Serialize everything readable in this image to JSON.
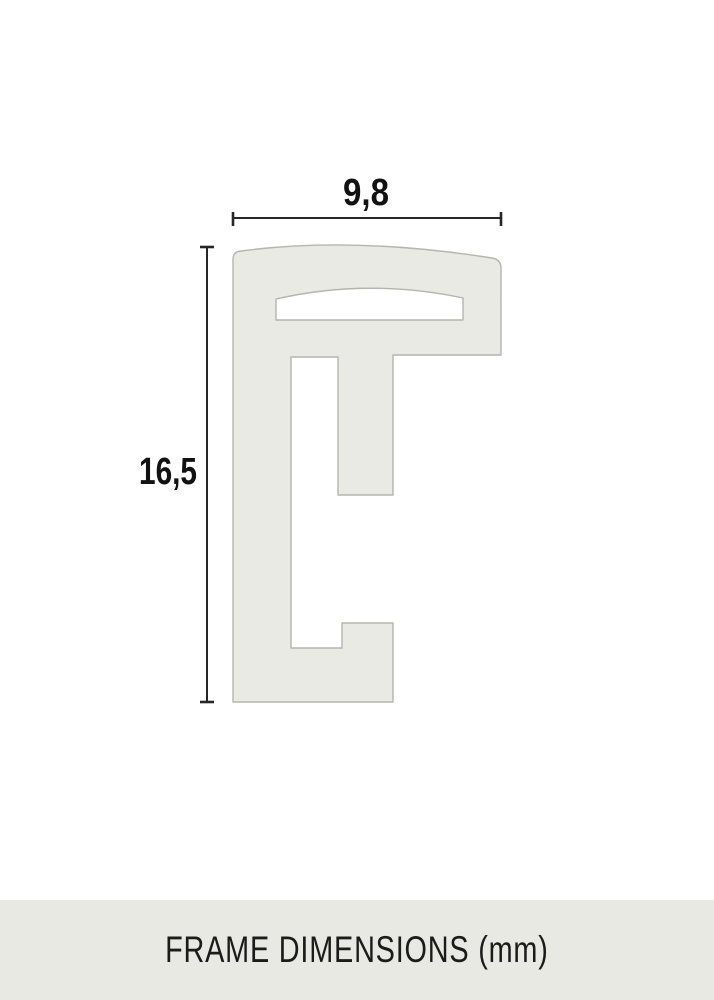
{
  "dimensions": {
    "width_label": "9,8",
    "height_label": "16,5"
  },
  "footer": {
    "caption": "FRAME DIMENSIONS (mm)"
  },
  "colors": {
    "background": "#ffffff",
    "profile_fill": "#e9eae4",
    "profile_outline": "#b3b5b0",
    "dimension_line": "#262626",
    "label_text": "#121212",
    "footer_background": "#e8e9e3",
    "footer_text": "#1b1b1b"
  }
}
